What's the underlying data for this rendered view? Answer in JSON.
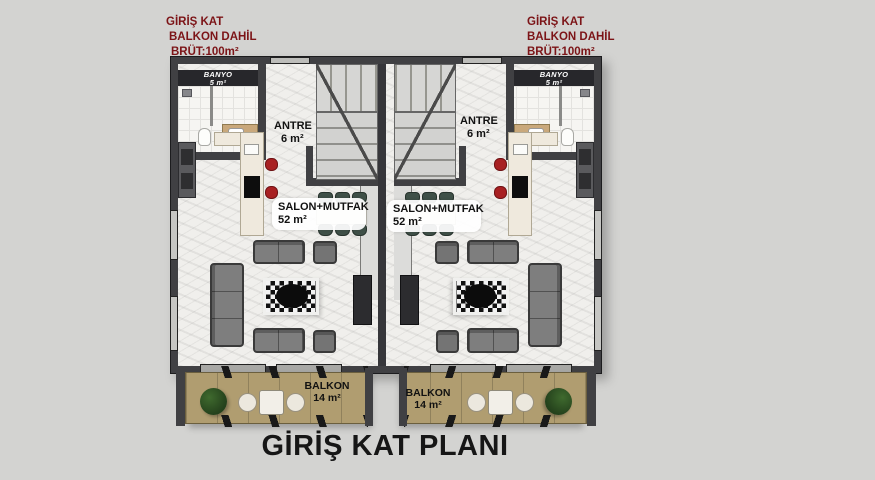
{
  "title": "GİRİŞ KAT PLANI",
  "annotation_left": {
    "line1": "GİRİŞ KAT",
    "line2": "BALKON DAHİL",
    "line3": "BRÜT:100m²"
  },
  "annotation_right": {
    "line1": "GİRİŞ KAT",
    "line2": "BALKON DAHİL",
    "line3": "BRÜT:100m²"
  },
  "rooms": {
    "left": {
      "banyo_name": "BANYO",
      "banyo_area": "5 m²",
      "antre_name": "ANTRE",
      "antre_area": "6 m²",
      "salon_name": "SALON+MUTFAK",
      "salon_area": "52 m²",
      "balkon_name": "BALKON",
      "balkon_area": "14 m²"
    },
    "right": {
      "banyo_name": "BANYO",
      "banyo_area": "5 m²",
      "antre_name": "ANTRE",
      "antre_area": "6 m²",
      "salon_name": "SALON+MUTFAK",
      "salon_area": "52 m²",
      "balkon_name": "BALKON",
      "balkon_area": "14 m²"
    }
  },
  "colors": {
    "background": "#d3d3d1",
    "wall": "#404043",
    "floor": "#f0efec",
    "wood": "#b09d70",
    "stool_red": "#a82022",
    "chair_green": "#3f5048",
    "annotation_red": "#7c1417",
    "title_black": "#161616"
  }
}
